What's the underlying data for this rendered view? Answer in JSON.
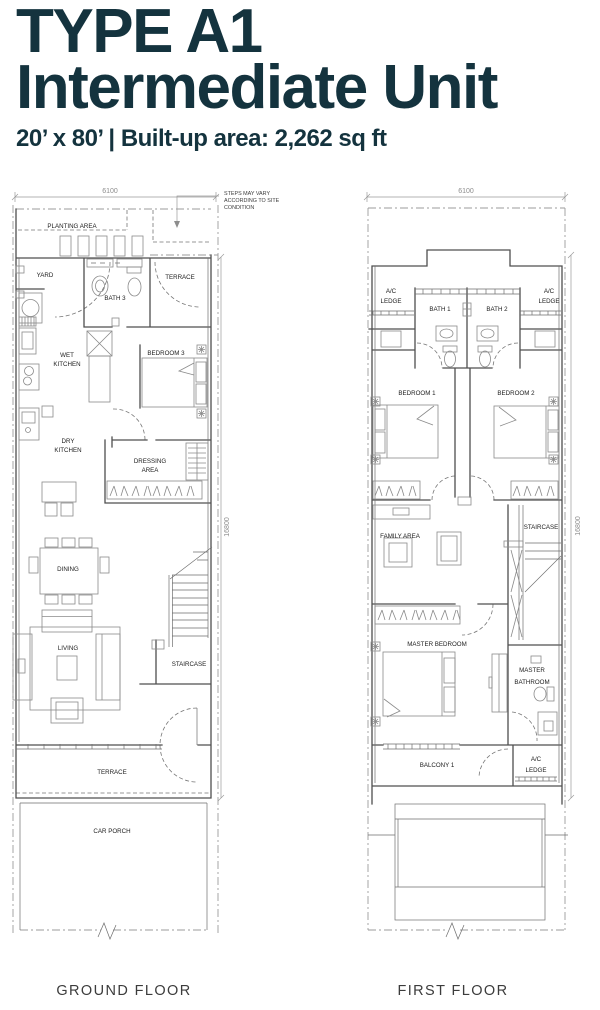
{
  "header": {
    "title_line1": "TYPE A1",
    "title_line2": "Intermediate Unit",
    "subtitle": "20’ x 80’ | Built-up area: 2,262 sq ft"
  },
  "colors": {
    "title_text": "#14333e",
    "caption_text": "#3c3c3c",
    "wall_line": "#4f4f4f",
    "light_line": "#8a8a8a"
  },
  "ground_floor": {
    "caption": "GROUND FLOOR",
    "dim_width": "6100",
    "dim_height": "16800",
    "note": {
      "line1": "STEPS MAY VARY",
      "line2": "ACCORDING  TO SITE",
      "line3": "CONDITION"
    },
    "rooms": {
      "planting_area": "PLANTING AREA",
      "yard": "YARD",
      "terrace_rear": "TERRACE",
      "bath_3": "BATH 3",
      "wet_kitchen_l1": "WET",
      "wet_kitchen_l2": "KITCHEN",
      "bedroom_3": "BEDROOM 3",
      "dry_kitchen_l1": "DRY",
      "dry_kitchen_l2": "KITCHEN",
      "dressing_l1": "DRESSING",
      "dressing_l2": "AREA",
      "dining": "DINING",
      "living": "LIVING",
      "staircase": "STAIRCASE",
      "terrace_front": "TERRACE",
      "car_porch": "CAR PORCH"
    }
  },
  "first_floor": {
    "caption": "FIRST FLOOR",
    "dim_width": "6100",
    "dim_height": "16800",
    "rooms": {
      "ac_ledge_left_l1": "A/C",
      "ac_ledge_left_l2": "LEDGE",
      "ac_ledge_right_l1": "A/C",
      "ac_ledge_right_l2": "LEDGE",
      "bath_1": "BATH 1",
      "bath_2": "BATH 2",
      "bedroom_1": "BEDROOM 1",
      "bedroom_2": "BEDROOM 2",
      "family_area": "FAMILY AREA",
      "staircase": "STAIRCASE",
      "master_bedroom": "MASTER BEDROOM",
      "master_bathroom_l1": "MASTER",
      "master_bathroom_l2": "BATHROOM",
      "balcony_1": "BALCONY 1",
      "ac_ledge_bottom_l1": "A/C",
      "ac_ledge_bottom_l2": "LEDGE"
    }
  }
}
